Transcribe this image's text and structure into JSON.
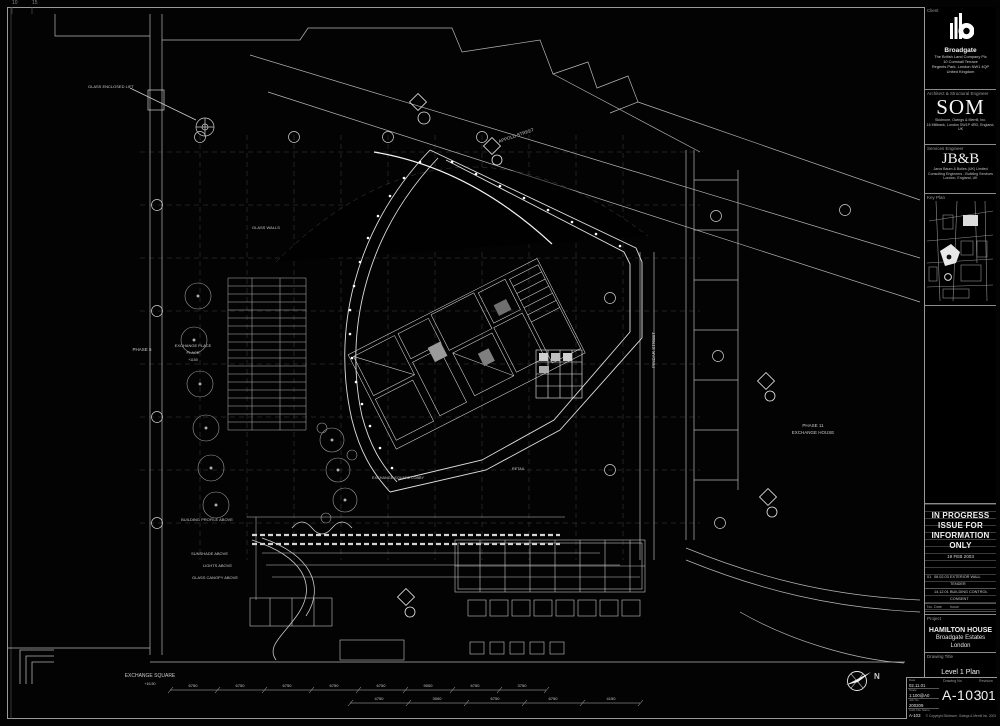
{
  "corner_marks": {
    "m1": "10",
    "m2": "15"
  },
  "plan": {
    "labels": {
      "glass_lift": "GLASS ENCLOSED LIFT",
      "glass_walls": "GLASS WALLS",
      "phase5": "PHASE 5",
      "exchange_place1": "EXCHANGE PLACE",
      "exchange_place2": "PLACE",
      "exchange_place3": "+1150",
      "appold_street": "APPOLD STREET",
      "pindar_street": "PINDAR STREET",
      "phase11_1": "PHASE 11",
      "phase11_2": "EXCHANGE HOUSE",
      "building_profile": "BUILDING PROFILE ABOVE",
      "sunshade": "SUNSHADE ABOVE",
      "lights": "LIGHTS ABOVE",
      "glass_canopy": "GLASS CANOPY ABOVE",
      "exchange_lobby": "EXCHANGE SQUARE LOBBY",
      "retail": "RETAIL",
      "exchange_square1": "EXCHANGE SQUARE",
      "exchange_square2": "+16.50",
      "north": "N"
    },
    "dims_bottom": [
      "6750",
      "6750",
      "6750",
      "6750",
      "6750",
      "9000",
      "6750",
      "3750"
    ],
    "dims_bottom2": [
      "4750",
      "3000",
      "6750",
      "6750",
      "4150"
    ]
  },
  "titleblock": {
    "client_header": "Client",
    "client": {
      "name": "Broadgate",
      "address1": "The British Land Company Plc",
      "address2": "10 Cornwall Terrace",
      "address3": "Regents Park, London NW1 4QP",
      "address4": "United Kingdom"
    },
    "architect_header": "Architect & Structural Engineer",
    "architect": {
      "name": "SOM",
      "line1": "Skidmore, Owings & Merrill, Inc.",
      "line2": "16 Millbank, London SW1P 4RD, England, UK"
    },
    "services_header": "Services Engineer",
    "services": {
      "name": "JB&B",
      "line1": "Jaros Baum & Bolles (UK) Limited",
      "line2": "Consulting Engineers - Building Services",
      "line3": "London, England, UK"
    },
    "keyplan_header": "Key Plan",
    "stamp": {
      "line1": "IN PROGRESS",
      "line2": "ISSUE FOR",
      "line3": "INFORMATION ONLY",
      "date": "19 FEB 2003"
    },
    "revisions": {
      "rows": [
        {
          "no": "01",
          "date": "06.02.03",
          "issue": "EXTERIOR WALL TENDER"
        },
        {
          "no": "",
          "date": "14.12.01",
          "issue": "BUILDING CONTROL CONSENT"
        }
      ],
      "header_no": "No.",
      "header_date": "Date",
      "header_issue": "Issue"
    },
    "project_header": "Project",
    "project": {
      "line1": "HAMILTON HOUSE",
      "line2": "Broadgate Estates",
      "line3": "London"
    },
    "drawing_title_header": "Drawing Title",
    "drawing_title": "Level 1 Plan",
    "info": {
      "date_label": "Date",
      "date": "02.11.01",
      "scale_label": "Scale",
      "scale": "1:100@A0",
      "job_label": "Job No",
      "job": "200209",
      "cad_label": "CAD File Name",
      "cad": "A-103"
    },
    "drawing_no_header": "Drawing No",
    "drawing_no": "A-103",
    "revision_header": "Revision",
    "revision": "01",
    "copyright": "© Copyright Skidmore, Owings & Merrill Inc. 2003"
  }
}
